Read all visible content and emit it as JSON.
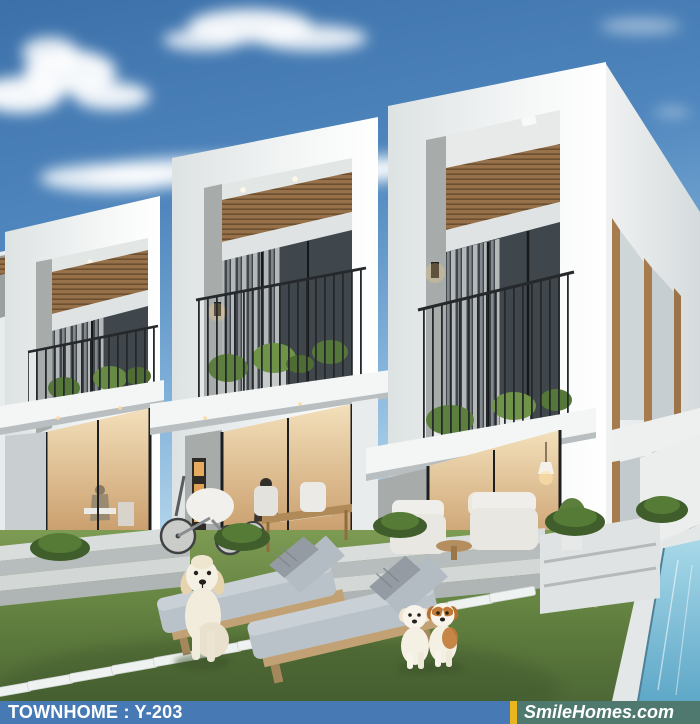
{
  "banner": {
    "left_label": "TOWNHOME : Y-203",
    "right_label": "SmileHomes.com"
  },
  "palette": {
    "banner_blue": "#4779b4",
    "banner_yellow": "#eab61e",
    "banner_teal": "#4f796f",
    "banner_text": "#ffffff",
    "sky_top": "#3c70a9",
    "sky_bottom": "#bcdcee",
    "grass": "#6f8f4a",
    "grass_dark": "#4d6836",
    "building_white": "#f2f4f4",
    "concrete_grey": "#a9aeae",
    "wood_slat": "#96714a",
    "glass_dark": "#3f464c",
    "interior_warm": "#e3bc84",
    "pool_water": "#8ecbe2",
    "railing_black": "#26292c"
  },
  "scene": {
    "subject": "three modern white townhome units with balconies, lawn, lap pool, two loungers and three dogs",
    "units_count": 3,
    "dogs_count": 3,
    "loungers_count": 2
  }
}
